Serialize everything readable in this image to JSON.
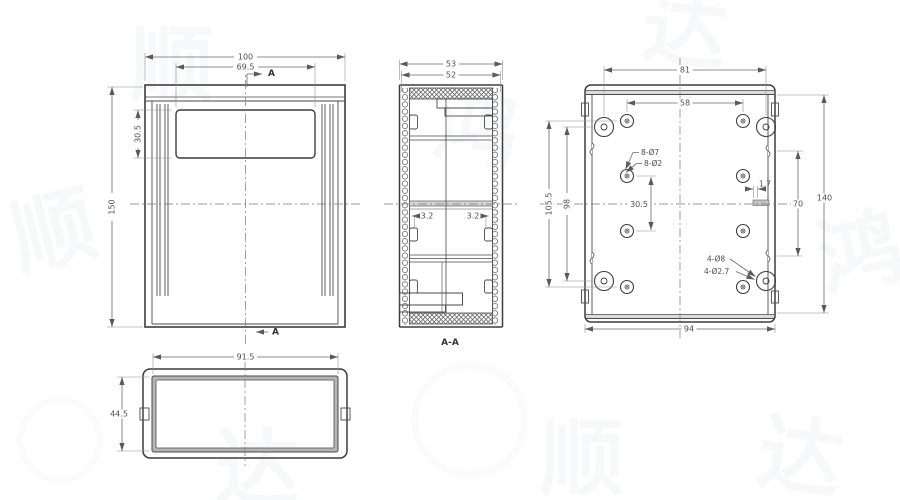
{
  "front_view": {
    "dim_overall_width": "100",
    "dim_panel_width": "69.5",
    "dim_panel_height": "30.5",
    "dim_overall_height": "150",
    "section_arrow_top": "A",
    "section_arrow_bottom": "A"
  },
  "section_view": {
    "dim_outer_depth": "53",
    "dim_inner_depth": "52",
    "dim_wall_left": "3.2",
    "dim_wall_right": "3.2",
    "label": "A-A"
  },
  "back_view": {
    "dim_boss_span_width": "81",
    "dim_hole_span_width": "58",
    "dim_hole_span_height": "105.5",
    "dim_boss_span_height": "98",
    "dim_center_holes": "30.5",
    "dim_notch": "1.7",
    "dim_rib_span": "70",
    "dim_overall_height": "140",
    "dim_bottom_width": "94",
    "callout_hole_outer": "8-Ø7",
    "callout_hole_inner": "8-Ø2",
    "callout_boss_outer": "4-Ø8",
    "callout_boss_inner": "4-Ø2.7"
  },
  "top_view": {
    "dim_inner_width": "91.5",
    "dim_inner_height": "44.5"
  },
  "watermark": {
    "chars": [
      "顺",
      "达",
      "鸿",
      "顺",
      "达",
      "鸿",
      "顺",
      "达"
    ]
  }
}
